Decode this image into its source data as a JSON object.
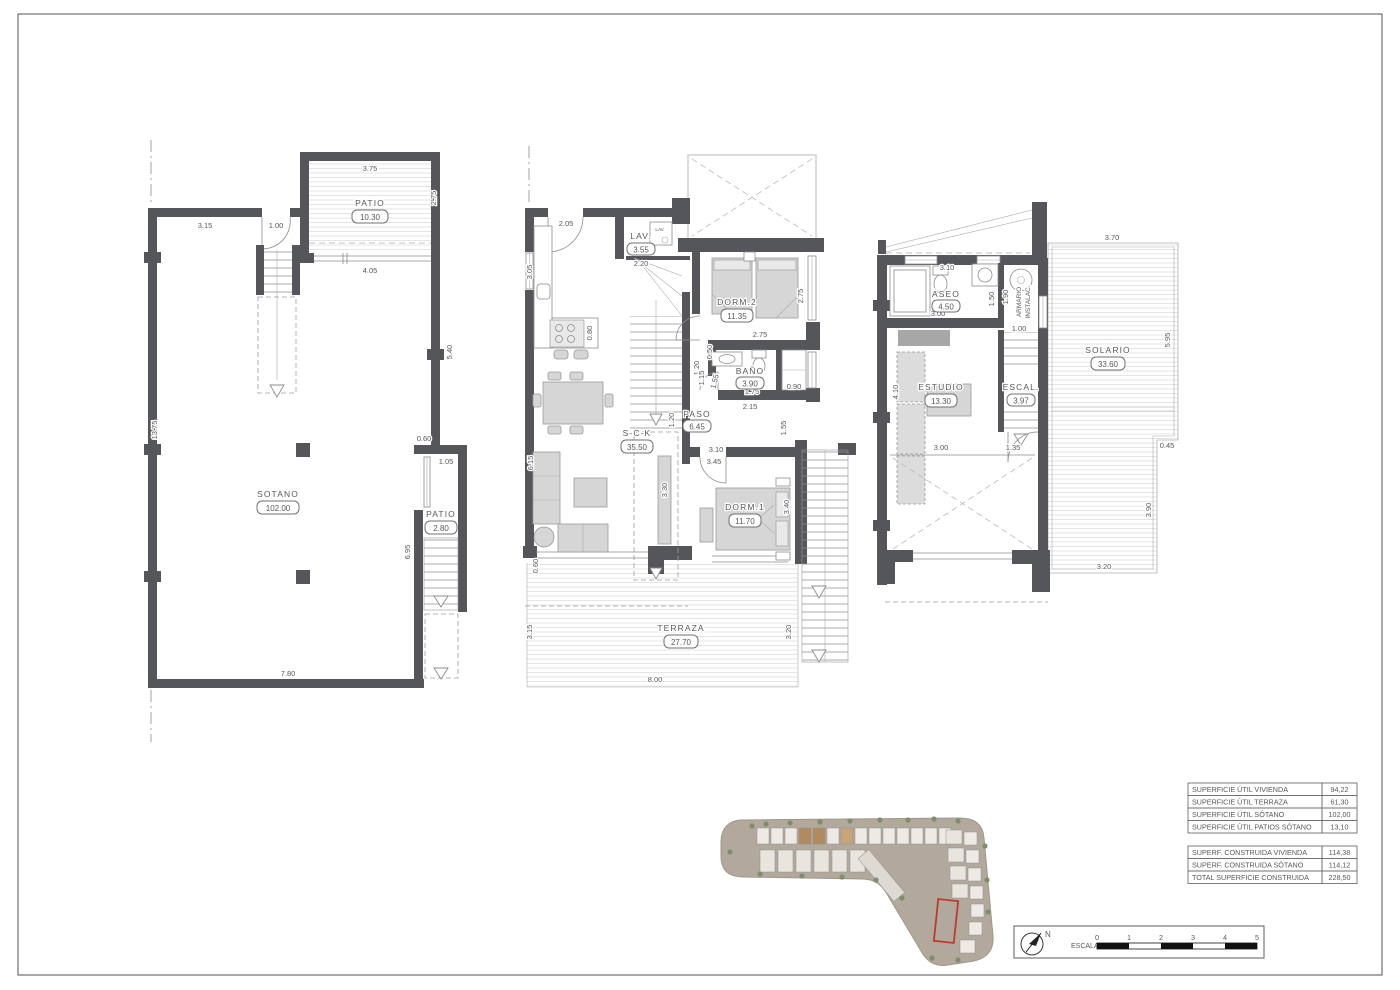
{
  "colors": {
    "wall": "#55565a",
    "accent_red": "#c0392b"
  },
  "sotano": {
    "rooms": [
      {
        "label": "PATIO",
        "area": "10.30"
      },
      {
        "label": "SOTANO",
        "area": "102.00"
      },
      {
        "label": "PATIO",
        "area": "2.80"
      }
    ],
    "dims": [
      "3.75",
      "2.75",
      "3.15",
      "1.00",
      "4.05",
      "5.40",
      "13.75",
      "0.60",
      "1.05",
      "6.95",
      "7.80"
    ]
  },
  "baja": {
    "rooms": [
      {
        "label": "LAV.",
        "area": "3.55"
      },
      {
        "label": "DORM.2",
        "area": "11.35"
      },
      {
        "label": "BAÑO",
        "area": "3.90"
      },
      {
        "label": "PASO",
        "area": "6.45"
      },
      {
        "label": "S-C-K",
        "area": "35.50"
      },
      {
        "label": "DORM.1",
        "area": "11.70"
      },
      {
        "label": "TERRAZA",
        "area": "27.70"
      }
    ],
    "appliance_label": "LAV.",
    "dims": [
      "2.05",
      "2.20",
      "3.05",
      "0.80",
      "6.15",
      "0.60",
      "3.15",
      "3.20",
      "8.00",
      "1.20",
      "1.20",
      "0.50",
      "1.15",
      "1.55",
      "2.75",
      "2.75",
      "0.90",
      "1.75",
      "2.15",
      "1.55",
      "3.10",
      "3.45",
      "3.40",
      "3.30"
    ]
  },
  "alta": {
    "rooms": [
      {
        "label": "ASEO",
        "area": "4.50"
      },
      {
        "label": "ESTUDIO",
        "area": "13.30"
      },
      {
        "label": "ESCAL.",
        "area": "3.97"
      },
      {
        "label": "SOLARIO",
        "area": "33.60"
      }
    ],
    "armario_line1": "ARMARIO",
    "armario_line2": "INSTALAC.",
    "dims": [
      "3.10",
      "1.50",
      "1.90",
      "1.00",
      "3.00",
      "4.10",
      "3.70",
      "5.95",
      "0.45",
      "3.90",
      "3.20",
      "3.00",
      "1.35"
    ]
  },
  "areas_table": {
    "util": [
      {
        "label": "SUPERFICIE ÚTIL VIVIENDA",
        "value": "94,22"
      },
      {
        "label": "SUPERFICIE ÚTIL TERRAZA",
        "value": "61,30"
      },
      {
        "label": "SUPERFICIE ÚTIL SÓTANO",
        "value": "102,00"
      },
      {
        "label": "SUPERFICIE ÚTIL PATIOS SÓTANO",
        "value": "13,10"
      }
    ],
    "construida": [
      {
        "label": "SUPERF. CONSTRUIDA VIVIENDA",
        "value": "114,38"
      },
      {
        "label": "SUPERF. CONSTRUIDA SÓTANO",
        "value": "114,12"
      },
      {
        "label": "TOTAL SUPERFICIE CONSTRUIDA",
        "value": "228,50"
      }
    ]
  },
  "scalebar": {
    "north_label": "N",
    "scale_label": "ESCALA :",
    "ticks": [
      "0",
      "1",
      "2",
      "3",
      "4",
      "5"
    ]
  }
}
